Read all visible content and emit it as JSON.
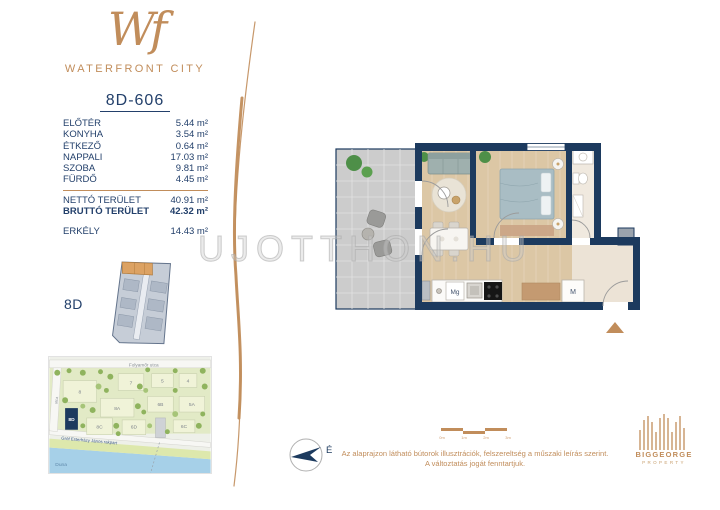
{
  "brand": {
    "logo": "Wf",
    "name": "WATERFRONT CITY"
  },
  "unit": {
    "id": "8D-606",
    "rooms": [
      {
        "label": "ELŐTÉR",
        "area": "5.44 m²"
      },
      {
        "label": "KONYHA",
        "area": "3.54 m²"
      },
      {
        "label": "ÉTKEZŐ",
        "area": "0.64 m²"
      },
      {
        "label": "NAPPALI",
        "area": "17.03 m²"
      },
      {
        "label": "SZOBA",
        "area": "9.81 m²"
      },
      {
        "label": "FÜRDŐ",
        "area": "4.45 m²"
      }
    ],
    "totals": [
      {
        "label": "NETTÓ TERÜLET",
        "area": "40.91 m²"
      },
      {
        "label": "BRUTTÓ TERÜLET",
        "area": "42.32 m²"
      }
    ],
    "extra": {
      "label": "ERKÉLY",
      "area": "14.43 m²"
    }
  },
  "keyplan": {
    "label": "8D"
  },
  "floorplan": {
    "washing_machine_label": "Mg",
    "wardrobe_label": "M"
  },
  "watermark": "UJOTTHON.HU",
  "map": {
    "street_top": "Folyamőr utca",
    "street_embankment": "Gróf Esterházy János rakpart",
    "street_left": "utca",
    "river": "Duna",
    "buildings": [
      "8",
      "7",
      "5",
      "4",
      "8A",
      "6B",
      "5A",
      "8D",
      "8C",
      "6D",
      "6C"
    ]
  },
  "compass": {
    "north_label": "É"
  },
  "scalebar": {
    "labels": [
      "0m",
      "1m",
      "2m",
      "3m"
    ]
  },
  "disclaimer": {
    "line1": "Az alaprajzon látható bútorok illusztrációk, felszereltség a műszaki leírás szerint.",
    "line2": "A változtatás jogát fenntartjuk."
  },
  "developer": {
    "name": "BIGGEORGE",
    "sub": "PROPERTY"
  },
  "colors": {
    "accent": "#c18d5b",
    "wall_navy": "#1c3a5e",
    "text_navy": "#23406b"
  }
}
